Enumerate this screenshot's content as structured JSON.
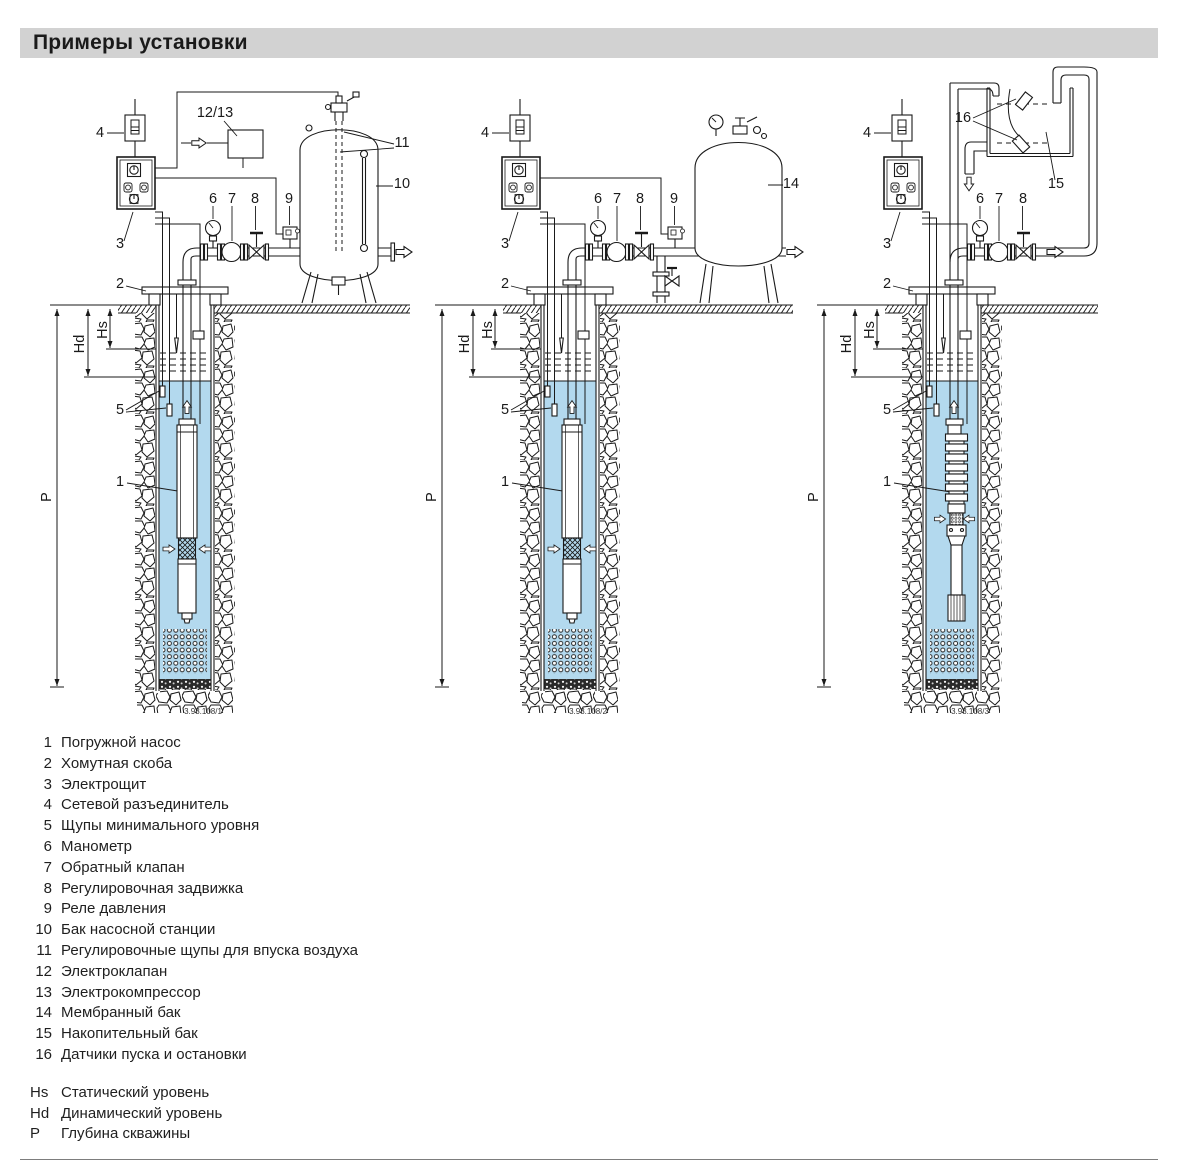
{
  "page": {
    "title": "Примеры установки"
  },
  "colors": {
    "header_bg": "#d2d2d2",
    "water": "#b3d9ee",
    "ink": "#1a1a1a"
  },
  "callouts": {
    "c1": "1",
    "c2": "2",
    "c3": "3",
    "c4": "4",
    "c5": "5",
    "c6": "6",
    "c7": "7",
    "c8": "8",
    "c9": "9",
    "c10": "10",
    "c11": "11",
    "c12_13": "12/13",
    "c14": "14",
    "c15": "15",
    "c16": "16",
    "hs": "Hs",
    "hd": "Hd",
    "p": "P"
  },
  "captions": {
    "d1": "3.93.108/1",
    "d2": "3.93.108/2",
    "d3": "3.93.108/3"
  },
  "legend": {
    "items": [
      {
        "num": "1",
        "label": "Погружной насос"
      },
      {
        "num": "2",
        "label": "Хомутная скоба"
      },
      {
        "num": "3",
        "label": "Электрощит"
      },
      {
        "num": "4",
        "label": "Сетевой разъединитель"
      },
      {
        "num": "5",
        "label": "Щупы минимального уровня"
      },
      {
        "num": "6",
        "label": "Манометр"
      },
      {
        "num": "7",
        "label": "Обратный клапан"
      },
      {
        "num": "8",
        "label": "Регулировочная задвижка"
      },
      {
        "num": "9",
        "label": "Реле давления"
      },
      {
        "num": "10",
        "label": "Бак насосной станции"
      },
      {
        "num": "11",
        "label": "Регулировочные щупы для впуска воздуха"
      },
      {
        "num": "12",
        "label": "Электроклапан"
      },
      {
        "num": "13",
        "label": "Электрокомпрессор"
      },
      {
        "num": "14",
        "label": "Мембранный бак"
      },
      {
        "num": "15",
        "label": "Накопительный бак"
      },
      {
        "num": "16",
        "label": "Датчики пуска и остановки"
      }
    ],
    "levels": [
      {
        "sym": "Hs",
        "label": "Статический уровень"
      },
      {
        "sym": "Hd",
        "label": "Динамический уровень"
      },
      {
        "sym": "P",
        "label": "Глубина скважины"
      }
    ]
  }
}
